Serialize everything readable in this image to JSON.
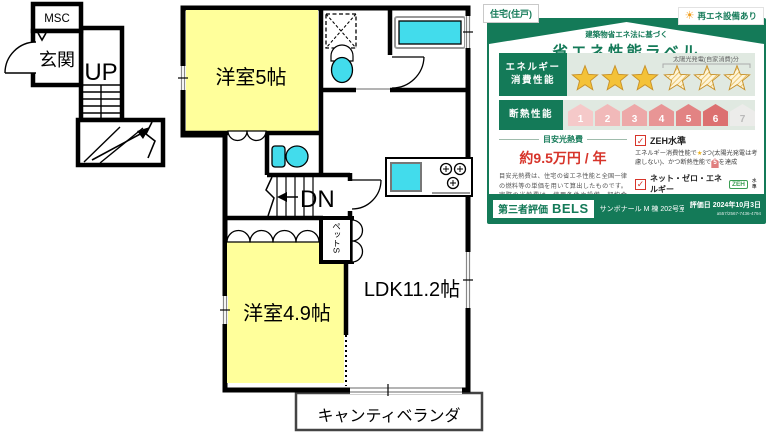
{
  "theme": {
    "green": "#147a58",
    "rowbg": "#e0e9e1",
    "red": "#d7342a",
    "gold": "#f4c238",
    "cyan": "#42dcec",
    "yellow": "#ffff9b"
  },
  "floor_plan": {
    "labels": {
      "msc": "MSC",
      "entrance": "玄関",
      "up": "UP",
      "dn": "DN",
      "room5": "洋室5帖",
      "room49": "洋室4.9帖",
      "ldk": "LDK11.2帖",
      "balcony": "キャンティベランダ",
      "pet_closet": "ペットS"
    }
  },
  "energy_label": {
    "tags": {
      "left": "住宅(住戸)",
      "right": "再エネ設備あり"
    },
    "icons": {
      "sun": "☀",
      "check": "✓"
    },
    "title": {
      "sub": "建築物省エネ法に基づく",
      "main": "省エネ性能ラベル"
    },
    "energy_row": {
      "label_line1": "エネルギー",
      "label_line2": "消費性能",
      "stars_total": 6,
      "stars_solid": 3,
      "stars_solar": 3,
      "solar_note": "太陽光発電(自家消費)分"
    },
    "insulation_row": {
      "label": "断熱性能",
      "levels": [
        "1",
        "2",
        "3",
        "4",
        "5",
        "6",
        "7"
      ],
      "achieved_max": 6
    },
    "cost": {
      "header": "目安光熱費",
      "value": "約9.5万円 / 年",
      "note": "目安光熱費は、住宅の省エネ性能と全国一律の燃料等の単価を用いて算出したものです。実際の光熱費は、使用条件や設備、契約会社・方法などにより異なります。"
    },
    "zeh": {
      "item1_title": "ZEH水準",
      "note1_pre": "エネルギー消費性能で",
      "star": "★",
      "note1_mid": "3つ(太陽光発電は考慮しない)、かつ断熱性能で",
      "insulation_badge": "5",
      "note1_post": "を達成",
      "item2_title": "ネット・ゼロ・エネルギー",
      "badge": "ZEH",
      "badge_suffix": "水準",
      "note2": "NearlyZEH の要件は評価書をご覧ください。"
    },
    "footer": {
      "cert": "第三者評価",
      "brand": "BELS",
      "building": "サンボナール M 棟 202号室",
      "date": "評価日 2024年10月3日",
      "id": "a557/2567-7436-4794"
    }
  }
}
